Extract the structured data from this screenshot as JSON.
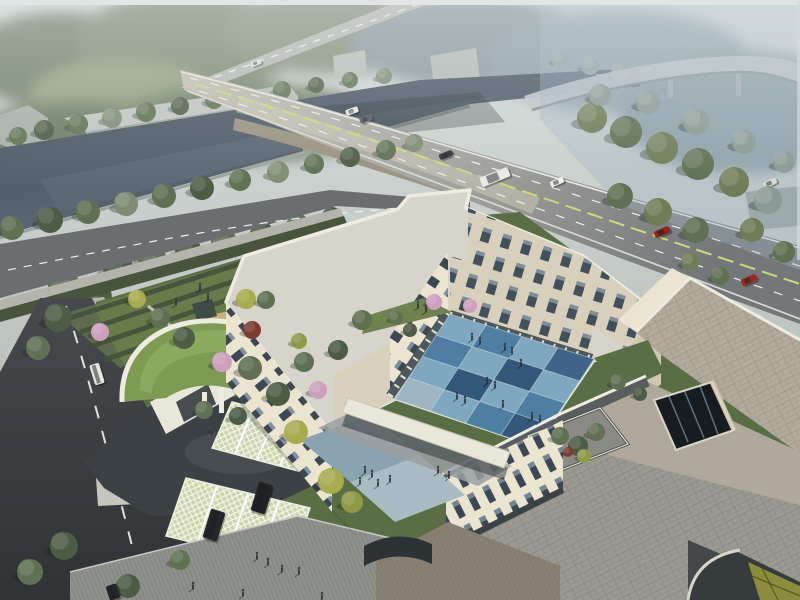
{
  "meta": {
    "kind": "aerial-architectural-rendering",
    "subject": "campus building complex with courtyard, river bridge and roads",
    "width": 800,
    "height": 600
  },
  "palette": {
    "sky_top": "#e2e5e6",
    "haze_right": "#a4b6c3",
    "forest_dk": "#4d5c45",
    "forest_md": "#5f7152",
    "forest_lt": "#7e8c73",
    "forest_haze": "#8b9a96",
    "olive": "#6f7d57",
    "yellow_tree": "#a8ab4e",
    "yellowgreen_tree": "#8e9a46",
    "pink_tree": "#cfa0bd",
    "red_tree": "#7e3b30",
    "water_dk": "#404c59",
    "water_lt": "#5c6974",
    "bank_stone": "#9aa39d",
    "road_far": "#b7bab4",
    "bridge_deck": "#c6c0b0",
    "bridge_side": "#9a927f",
    "road_mid": "#86888a",
    "road_dark_end": "#74777a",
    "front_road": "#6b6e70",
    "v_road": "#404448",
    "lane_white": "#eef0ea",
    "lane_yellow": "#ccd87c",
    "kerb": "#b5b4ac",
    "shed_wall": "#a9b0a9",
    "shed_roof": "#c2c7c2",
    "viaduct": "#c3c8cb",
    "viaduct_under": "#7e868b",
    "lawn": "#5a6e45",
    "lawn_lt": "#6f8350",
    "hedge": "#42513a",
    "sand": "#c9b277",
    "canopy_dark": "#3f4b47",
    "green_roof": "#7d9b53",
    "green_roof_lt": "#93b063",
    "paver_bay": "#ccd5aa",
    "drive_asphalt": "#3c4145",
    "plaza_stripe": "#8f918c",
    "terrace_brown": "#8a8072",
    "canopy_white": "#e9e7da",
    "cream": "#ebe4cf",
    "cream_dk": "#d8d0ba",
    "cream_dkr": "#cfc7b0",
    "roof_grey": "#d6d4cb",
    "roof_paver": "#9b9992",
    "roof_paver_beige": "#b3aa9c",
    "roof_border": "#595d60",
    "parapet": "#eeebe0",
    "atrium_dark": "#171c21",
    "glass": "#5d7383",
    "glass_yellow": "#8c8c3e",
    "blue_plaza_a": "#8aa3b0",
    "blue_plaza_b": "#a9bcc4",
    "person": "#2b3036"
  },
  "courtyard": {
    "corners": {
      "n": [
        450,
        314
      ],
      "e": [
        594,
        359
      ],
      "s": [
        536,
        447
      ],
      "w": [
        395,
        399
      ]
    },
    "rows": 4,
    "cols": 4,
    "tile_colors": {
      "pale": "#9db6c4",
      "lt": "#7fa7bf",
      "md": "#4f7ea3",
      "dk": "#35587a",
      "deep": "#3f6488"
    },
    "matrix": [
      [
        "lt",
        "md",
        "lt",
        "deep"
      ],
      [
        "md",
        "lt",
        "dk",
        "lt"
      ],
      [
        "lt",
        "dk",
        "lt",
        "md"
      ],
      [
        "pale",
        "lt",
        "md",
        "dk"
      ]
    ],
    "grid_line": "#c9d7df"
  },
  "trees": [
    [
      18,
      136,
      9,
      "forest_md",
      "bg"
    ],
    [
      44,
      130,
      10,
      "forest_dk",
      "bg"
    ],
    [
      78,
      124,
      10,
      "forest_md",
      "bg"
    ],
    [
      112,
      118,
      10,
      "forest_lt",
      "bg"
    ],
    [
      146,
      112,
      10,
      "forest_md",
      "bg"
    ],
    [
      180,
      106,
      9,
      "forest_dk",
      "bg"
    ],
    [
      214,
      100,
      9,
      "forest_md",
      "bg"
    ],
    [
      248,
      95,
      9,
      "forest_lt",
      "bg"
    ],
    [
      282,
      90,
      9,
      "forest_md",
      "bg"
    ],
    [
      316,
      85,
      8,
      "forest_dk",
      "bg"
    ],
    [
      350,
      80,
      8,
      "forest_md",
      "bg"
    ],
    [
      384,
      76,
      8,
      "forest_lt",
      "bg"
    ],
    [
      560,
      60,
      8,
      "forest_haze",
      "bg"
    ],
    [
      590,
      66,
      9,
      "forest_haze",
      "bg"
    ],
    [
      620,
      72,
      9,
      "forest_haze",
      "bg"
    ],
    [
      12,
      228,
      12,
      "forest_md",
      "mid"
    ],
    [
      50,
      220,
      13,
      "forest_dk",
      "mid"
    ],
    [
      88,
      212,
      12,
      "forest_md",
      "mid"
    ],
    [
      126,
      204,
      12,
      "forest_lt",
      "mid"
    ],
    [
      164,
      196,
      12,
      "forest_md",
      "mid"
    ],
    [
      202,
      188,
      12,
      "forest_dk",
      "mid"
    ],
    [
      240,
      180,
      11,
      "forest_md",
      "mid"
    ],
    [
      278,
      172,
      11,
      "forest_lt",
      "mid"
    ],
    [
      314,
      164,
      10,
      "forest_md",
      "mid"
    ],
    [
      350,
      157,
      10,
      "forest_dk",
      "mid"
    ],
    [
      386,
      150,
      10,
      "forest_md",
      "mid"
    ],
    [
      414,
      143,
      9,
      "forest_lt",
      "mid"
    ],
    [
      92,
      298,
      20,
      "forest_dk",
      "mid"
    ],
    [
      64,
      286,
      16,
      "forest_md",
      "mid"
    ],
    [
      118,
      268,
      15,
      "forest_dk",
      "mid"
    ],
    [
      152,
      258,
      14,
      "forest_md",
      "mid"
    ],
    [
      188,
      250,
      13,
      "forest_dk",
      "mid"
    ],
    [
      224,
      242,
      13,
      "forest_md",
      "mid"
    ],
    [
      262,
      234,
      12,
      "forest_dk",
      "mid"
    ],
    [
      298,
      226,
      12,
      "forest_md",
      "mid"
    ],
    [
      332,
      218,
      11,
      "forest_dk",
      "mid"
    ],
    [
      592,
      118,
      15,
      "olive",
      "mid"
    ],
    [
      626,
      132,
      16,
      "forest_md",
      "mid"
    ],
    [
      662,
      148,
      16,
      "olive",
      "mid"
    ],
    [
      698,
      164,
      16,
      "forest_md",
      "mid"
    ],
    [
      734,
      182,
      15,
      "olive",
      "mid"
    ],
    [
      768,
      200,
      14,
      "forest_haze",
      "mid"
    ],
    [
      620,
      196,
      13,
      "forest_md",
      "mid"
    ],
    [
      658,
      212,
      14,
      "olive",
      "mid"
    ],
    [
      696,
      230,
      13,
      "forest_md",
      "mid"
    ],
    [
      600,
      95,
      11,
      "forest_haze",
      "mid"
    ],
    [
      648,
      102,
      12,
      "forest_haze",
      "mid"
    ],
    [
      696,
      122,
      13,
      "forest_haze",
      "mid"
    ],
    [
      744,
      142,
      12,
      "forest_haze",
      "mid"
    ],
    [
      784,
      162,
      11,
      "forest_haze",
      "mid"
    ],
    [
      752,
      230,
      12,
      "olive",
      "mid"
    ],
    [
      784,
      252,
      11,
      "forest_md",
      "mid"
    ],
    [
      100,
      332,
      9,
      "pink_tree",
      "fg"
    ],
    [
      222,
      362,
      10,
      "pink_tree",
      "fg"
    ],
    [
      318,
      390,
      9,
      "pink_tree",
      "fg"
    ],
    [
      434,
      302,
      8,
      "pink_tree",
      "fg"
    ],
    [
      470,
      306,
      7,
      "pink_tree",
      "fg"
    ],
    [
      137,
      299,
      9,
      "yellow_tree",
      "fg"
    ],
    [
      246,
      299,
      10,
      "yellow_tree",
      "fg"
    ],
    [
      296,
      432,
      12,
      "yellow_tree",
      "fg"
    ],
    [
      331,
      481,
      13,
      "yellow_tree",
      "fg"
    ],
    [
      352,
      502,
      11,
      "yellowgreen_tree",
      "fg"
    ],
    [
      299,
      341,
      8,
      "yellowgreen_tree",
      "fg"
    ],
    [
      160,
      318,
      10,
      "forest_md",
      "fg"
    ],
    [
      184,
      338,
      11,
      "forest_dk",
      "fg"
    ],
    [
      250,
      368,
      12,
      "forest_md",
      "fg"
    ],
    [
      278,
      394,
      12,
      "forest_dk",
      "fg"
    ],
    [
      304,
      362,
      10,
      "forest_md",
      "fg"
    ],
    [
      338,
      350,
      10,
      "forest_dk",
      "fg"
    ],
    [
      362,
      320,
      10,
      "forest_md",
      "fg"
    ],
    [
      58,
      318,
      14,
      "forest_dk",
      "fg"
    ],
    [
      38,
      348,
      12,
      "forest_md",
      "fg"
    ],
    [
      252,
      330,
      9,
      "red_tree",
      "fg"
    ],
    [
      204,
      410,
      9,
      "forest_md",
      "fg"
    ],
    [
      238,
      416,
      9,
      "forest_dk",
      "fg"
    ],
    [
      266,
      300,
      9,
      "forest_md",
      "fg"
    ],
    [
      64,
      546,
      14,
      "forest_dk",
      "fg"
    ],
    [
      30,
      572,
      13,
      "forest_md",
      "fg"
    ],
    [
      128,
      586,
      12,
      "forest_dk",
      "fg"
    ],
    [
      180,
      560,
      10,
      "forest_md",
      "fg"
    ],
    [
      396,
      318,
      7,
      "forest_md",
      "fg"
    ],
    [
      410,
      330,
      7,
      "forest_dk",
      "fg"
    ],
    [
      618,
      382,
      8,
      "forest_md",
      "fg"
    ],
    [
      640,
      394,
      7,
      "forest_dk",
      "fg"
    ],
    [
      560,
      436,
      9,
      "forest_md",
      "fg"
    ],
    [
      578,
      446,
      10,
      "forest_dk",
      "fg"
    ],
    [
      596,
      432,
      9,
      "forest_md",
      "fg"
    ],
    [
      584,
      456,
      7,
      "yellowgreen_tree",
      "fg"
    ],
    [
      568,
      452,
      5,
      "red_tree",
      "fg"
    ],
    [
      690,
      262,
      9,
      "olive",
      "fg"
    ],
    [
      720,
      276,
      9,
      "forest_md",
      "fg"
    ]
  ],
  "cars": [
    {
      "x": 352,
      "y": 111,
      "w": 13,
      "h": 6,
      "rot": -20,
      "color": "#e9e9e4",
      "label": "car",
      "layer": "road"
    },
    {
      "x": 366,
      "y": 119,
      "w": 13,
      "h": 6,
      "rot": -20,
      "color": "#54575b",
      "label": "car",
      "layer": "road"
    },
    {
      "x": 414,
      "y": 140,
      "w": 13,
      "h": 6,
      "rot": -21,
      "color": "#3e4145",
      "label": "car",
      "layer": "road"
    },
    {
      "x": 446,
      "y": 155,
      "w": 14,
      "h": 6,
      "rot": -21,
      "color": "#2e3235",
      "label": "car",
      "layer": "road"
    },
    {
      "x": 495,
      "y": 177,
      "w": 30,
      "h": 10,
      "rot": -22,
      "color": "#eaeae4",
      "label": "bus",
      "layer": "road"
    },
    {
      "x": 557,
      "y": 182,
      "w": 14,
      "h": 6,
      "rot": -23,
      "color": "#f0f0ea",
      "label": "car",
      "layer": "road"
    },
    {
      "x": 770,
      "y": 183,
      "w": 14,
      "h": 6,
      "rot": -25,
      "color": "#d8dad7",
      "label": "car",
      "layer": "road"
    },
    {
      "x": 662,
      "y": 232,
      "w": 16,
      "h": 7,
      "rot": -24,
      "color": "#8e2520",
      "label": "car-red",
      "layer": "road"
    },
    {
      "x": 749,
      "y": 280,
      "w": 16,
      "h": 7,
      "rot": -24,
      "color": "#9c2a23",
      "label": "car-red",
      "layer": "road"
    },
    {
      "x": 266,
      "y": 218,
      "w": 14,
      "h": 6,
      "rot": -12,
      "color": "#2d3033",
      "label": "car",
      "layer": "road"
    },
    {
      "x": 256,
      "y": 63,
      "w": 11,
      "h": 5,
      "rot": -22,
      "color": "#e7e7e1",
      "label": "bus",
      "layer": "road"
    },
    {
      "x": 97,
      "y": 374,
      "w": 10,
      "h": 21,
      "rot": -17,
      "color": "#e5e5df",
      "label": "van",
      "layer": "fg"
    },
    {
      "x": 113,
      "y": 592,
      "w": 11,
      "h": 15,
      "rot": -17,
      "color": "#24272a",
      "label": "car",
      "layer": "fg"
    },
    {
      "x": 262,
      "y": 498,
      "w": 15,
      "h": 30,
      "rot": 17,
      "color": "#1e2326",
      "label": "suv",
      "layer": "fg"
    },
    {
      "x": 214,
      "y": 525,
      "w": 15,
      "h": 30,
      "rot": 17,
      "color": "#22272b",
      "label": "suv",
      "layer": "fg"
    }
  ],
  "people": [
    [
      472,
      337
    ],
    [
      480,
      341
    ],
    [
      505,
      347
    ],
    [
      512,
      351
    ],
    [
      521,
      363
    ],
    [
      487,
      381
    ],
    [
      495,
      385
    ],
    [
      457,
      396
    ],
    [
      465,
      400
    ],
    [
      503,
      404
    ],
    [
      532,
      416
    ],
    [
      540,
      419
    ],
    [
      418,
      305
    ],
    [
      426,
      309
    ],
    [
      365,
      470
    ],
    [
      372,
      474
    ],
    [
      360,
      481
    ],
    [
      378,
      483
    ],
    [
      390,
      479
    ],
    [
      438,
      470
    ],
    [
      449,
      475
    ],
    [
      257,
      556
    ],
    [
      268,
      562
    ],
    [
      299,
      571
    ],
    [
      193,
      586
    ],
    [
      243,
      593
    ],
    [
      322,
      596
    ],
    [
      282,
      569
    ],
    [
      200,
      287
    ],
    [
      208,
      297
    ],
    [
      176,
      302
    ]
  ]
}
